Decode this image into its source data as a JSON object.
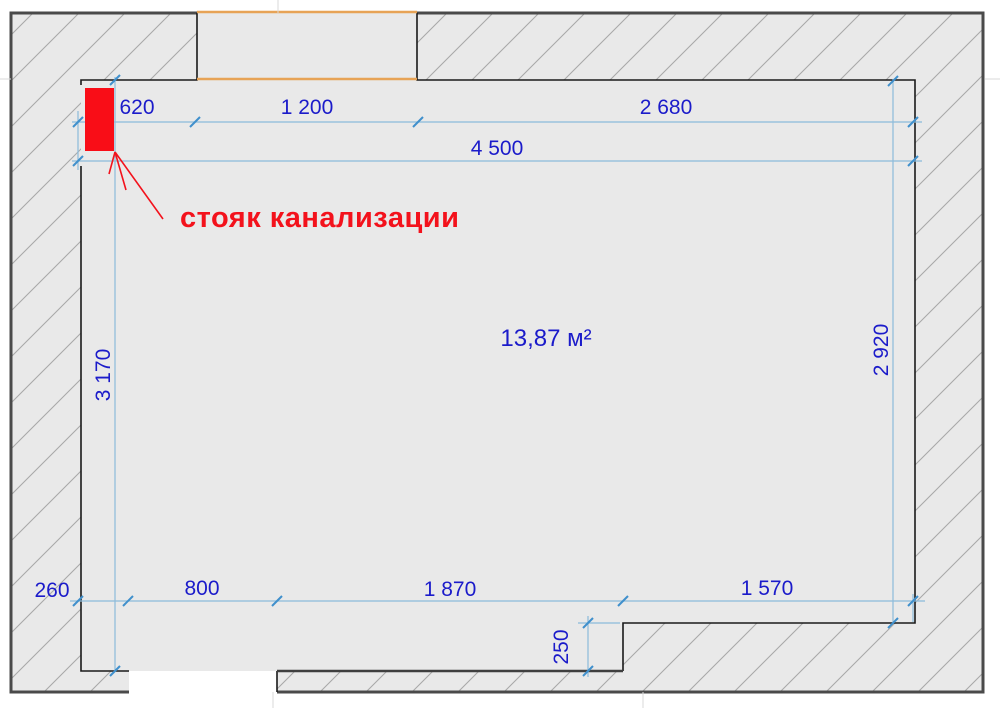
{
  "plan": {
    "area_label": "13,87 м²",
    "riser_label": "стояк канализации"
  },
  "dimensions": {
    "top_segments": [
      "620",
      "1 200",
      "2 680"
    ],
    "top_total": "4 500",
    "left_height": "3 170",
    "right_height": "2 920",
    "bottom_segments": [
      "260",
      "800",
      "1 870",
      "1 570"
    ],
    "ledge_depth": "250"
  },
  "colors": {
    "dimension_text": "#1b1bca",
    "dimension_line": "#8cbbdb",
    "tick_mark": "#4090cc",
    "wall_fill": "#e9e9e9",
    "hatch_line": "#a9a9a9",
    "outer_border": "#4a4a4a",
    "inner_border": "#1a1a1a",
    "window_line": "#e7a356",
    "riser_red": "#f90d17"
  }
}
